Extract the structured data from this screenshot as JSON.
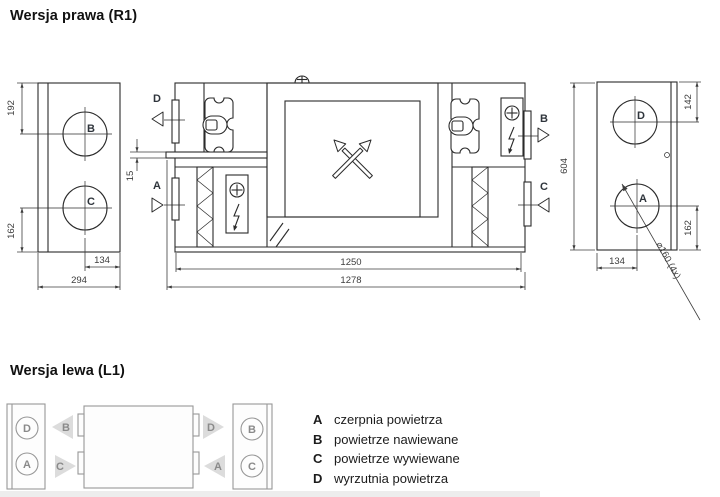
{
  "titles": {
    "right_version": "Wersja prawa (R1)",
    "left_version": "Wersja lewa (L1)"
  },
  "ports": {
    "a": "A",
    "b": "B",
    "c": "C",
    "d": "D"
  },
  "dimensions": {
    "left_view": {
      "top_to_port_b_center": "192",
      "port_c_center_to_bottom": "162",
      "port_center_inset": "134",
      "depth": "294"
    },
    "front_view": {
      "shelf_thickness": "15",
      "body_length": "1250",
      "overall_length": "1278",
      "height": "604"
    },
    "right_view": {
      "top_to_port_d_center": "142",
      "port_a_center_to_bottom": "162",
      "port_center_inset": "134",
      "port_diameter_note": "⌀160 (4x)"
    }
  },
  "legend": {
    "items": [
      {
        "key": "A",
        "label": "czerpnia powietrza"
      },
      {
        "key": "B",
        "label": "powietrze nawiewane"
      },
      {
        "key": "C",
        "label": "powietrze wywiewane"
      },
      {
        "key": "D",
        "label": "wyrzutnia powietrza"
      }
    ]
  },
  "icons": {
    "fan": "fan-impeller",
    "filter": "zigzag-filter",
    "heater": "electric-heater-plus-bolt",
    "heat_exchanger": "crossed-arrows",
    "lifting_eye": "lifting-eye",
    "drain": "drain-hatch"
  },
  "colors": {
    "line": "#2b2b2b",
    "dim": "#3d3d3d",
    "gray_line": "#979797",
    "gray_fill": "#dcdcdc",
    "text": "#1a1a1a"
  }
}
